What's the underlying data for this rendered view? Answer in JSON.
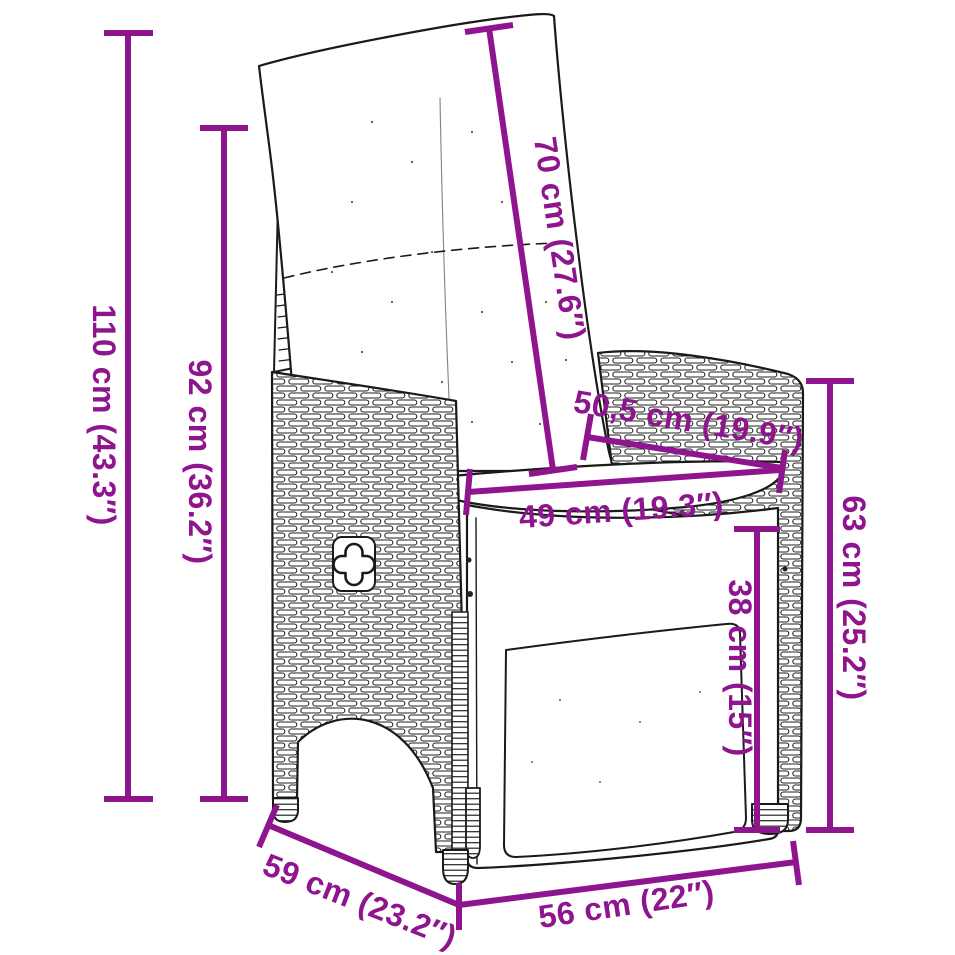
{
  "diagram": {
    "accent_color": "#8E158D",
    "line_color": "#1A1A1A",
    "dimensions": [
      {
        "id": "overall-height",
        "label": "110 cm (43.3″)"
      },
      {
        "id": "backrest-height",
        "label": "92 cm (36.2″)"
      },
      {
        "id": "back-cushion-length",
        "label": "70 cm (27.6″)"
      },
      {
        "id": "armrest-depth",
        "label": "50,5 cm (19.9″)"
      },
      {
        "id": "seat-width",
        "label": "49 cm (19.3″)"
      },
      {
        "id": "armrest-height",
        "label": "63 cm (25.2″)"
      },
      {
        "id": "seat-height",
        "label": "38 cm (15″)"
      },
      {
        "id": "depth",
        "label": "59 cm (23.2″)"
      },
      {
        "id": "width",
        "label": "56 cm (22″)"
      }
    ]
  }
}
